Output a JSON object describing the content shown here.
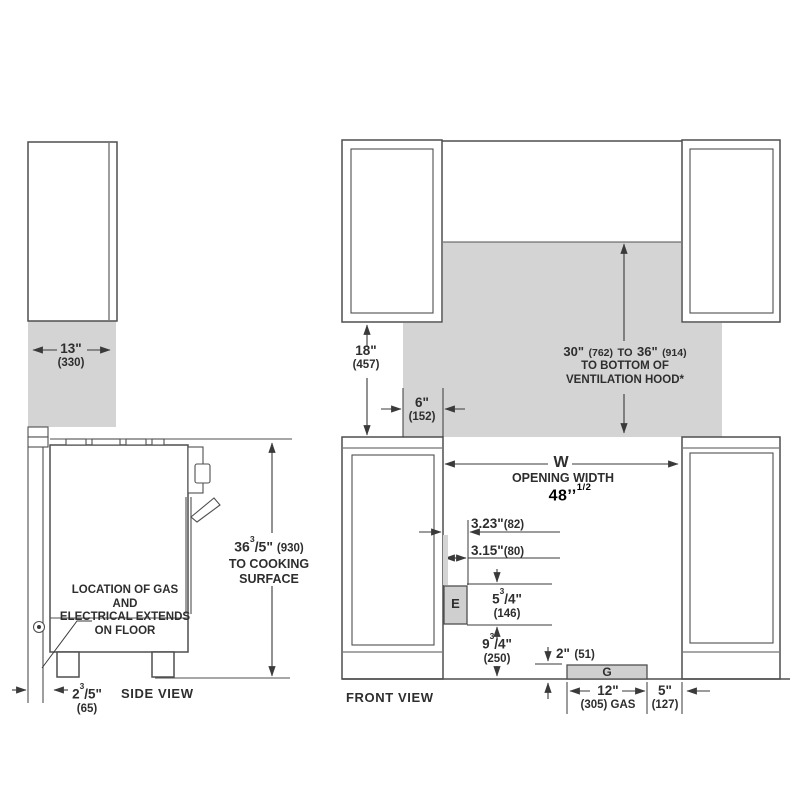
{
  "colors": {
    "bg": "#ffffff",
    "line": "#4f4f4f",
    "dim": "#3a3a3a",
    "fill": "#d4d4d4",
    "box_fill": "#cfcfcf",
    "text": "#2e2e2e",
    "highlight": "#000000"
  },
  "side_view": {
    "label": "SIDE VIEW",
    "cabinet_depth": {
      "inches": "13\"",
      "mm": "(330)"
    },
    "height_to_cooktop": {
      "whole": "36",
      "sup": "3",
      "frac": "/5\"",
      "mm": "(930)",
      "line2": "TO COOKING",
      "line3": "SURFACE"
    },
    "gas_note": {
      "line1": "LOCATION OF GAS AND",
      "line2": "ELECTRICAL EXTENDS",
      "line3": "ON FLOOR"
    },
    "rear_gap": {
      "whole": "2",
      "sup": "3",
      "frac": "/5\"",
      "mm": "(65)"
    }
  },
  "front_view": {
    "label": "FRONT VIEW",
    "upper_cabinet_height": {
      "inches": "18\"",
      "mm": "(457)"
    },
    "hood_overhang": {
      "inches": "6\"",
      "mm": "(152)"
    },
    "hood_clearance": {
      "v1": "30\"",
      "m1": "(762)",
      "to": "TO",
      "v2": "36\"",
      "m2": "(914)",
      "line2": "TO BOTTOM OF",
      "line3": "VENTILATION HOOD*"
    },
    "opening": {
      "letter": "W",
      "label": "OPENING WIDTH",
      "value": "48’’",
      "value_sup": "1/2"
    },
    "dim_3_23": {
      "inches": "3.23\"",
      "mm": "(82)"
    },
    "dim_3_15": {
      "inches": "3.15\"",
      "mm": "(80)"
    },
    "electrical_box": {
      "letter": "E"
    },
    "electrical_height": {
      "whole": "5",
      "sup": "3",
      "frac": "/4\"",
      "mm": "(146)"
    },
    "electrical_offset": {
      "whole": "9",
      "sup": "3",
      "frac": "/4\"",
      "mm": "(250)"
    },
    "gas_height": {
      "inches": "2\"",
      "mm": "(51)"
    },
    "gas_box": {
      "letter": "G"
    },
    "gas_width": {
      "inches": "12\"",
      "mm": "(305) GAS"
    },
    "gas_side": {
      "inches": "5\"",
      "mm": "(127)"
    }
  }
}
